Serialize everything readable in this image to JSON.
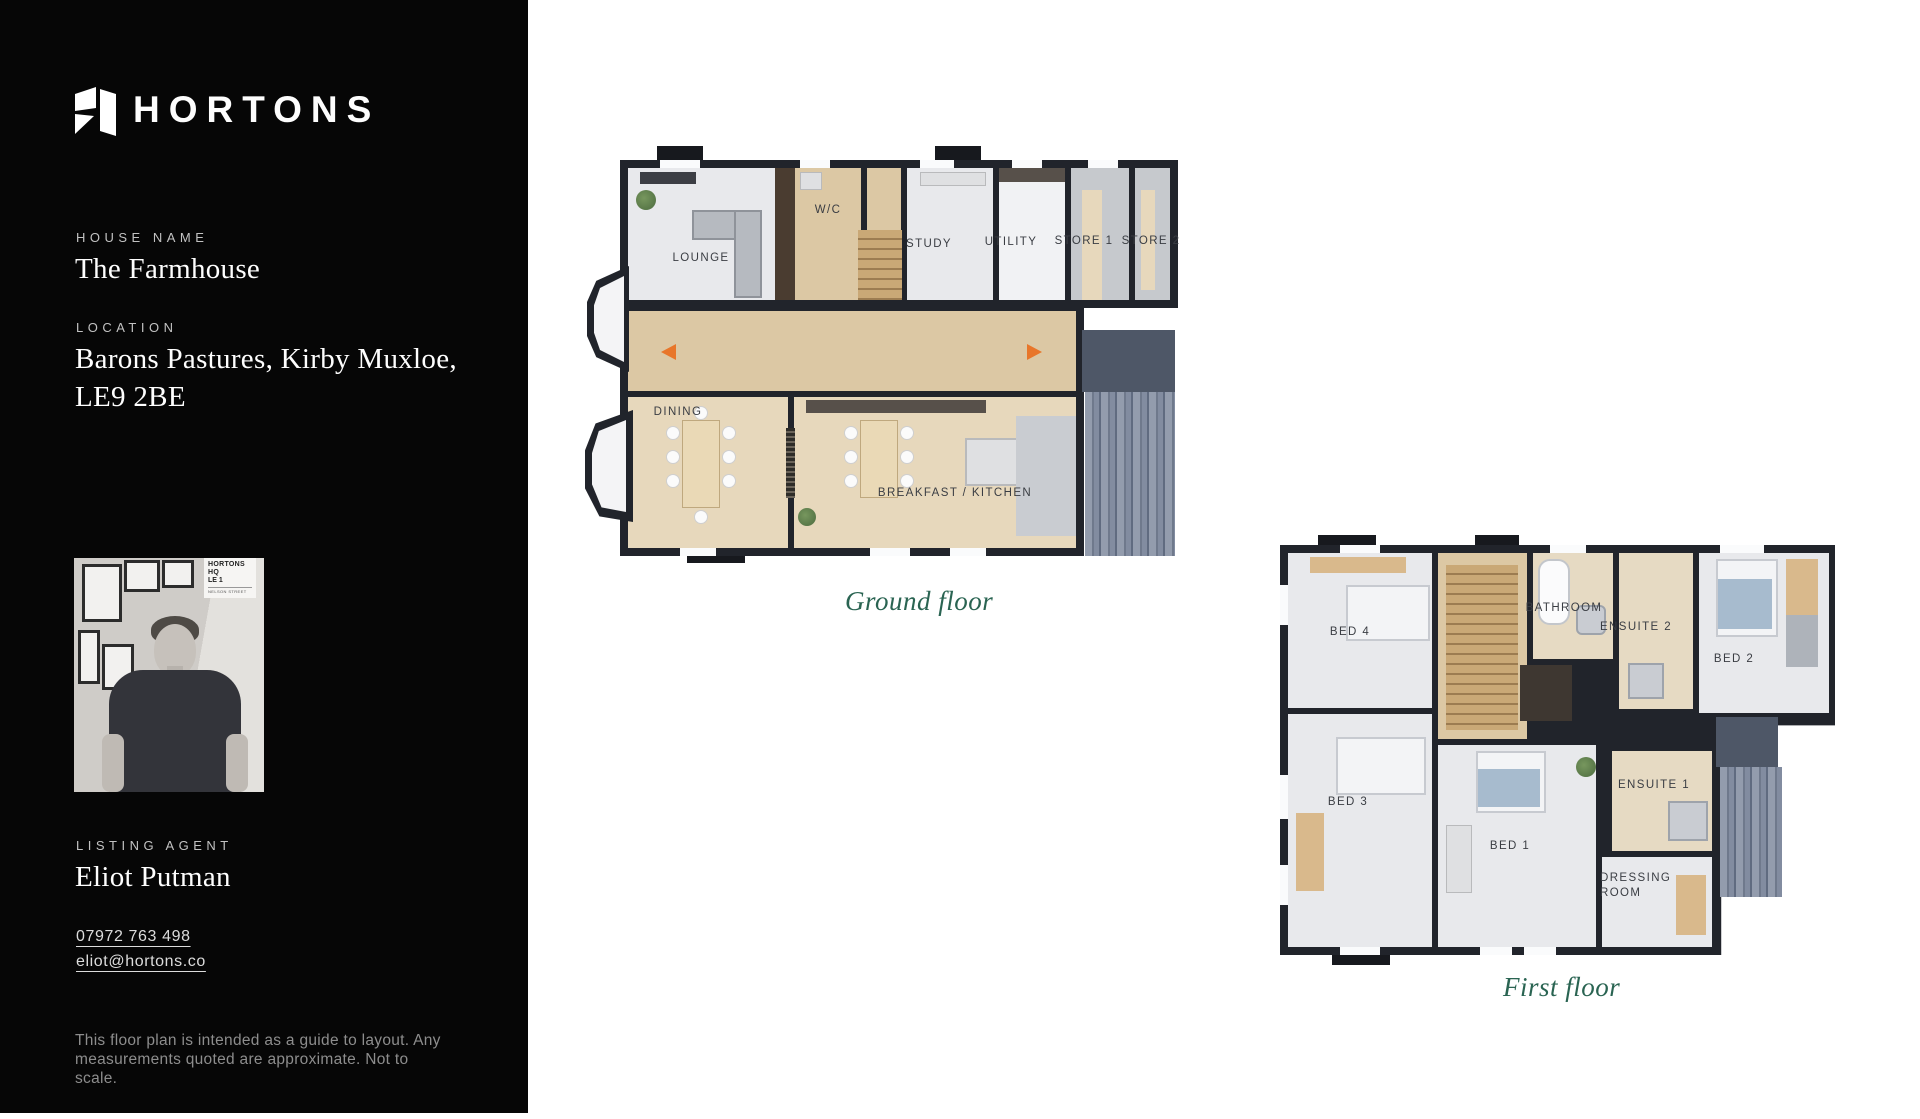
{
  "sidebar": {
    "brand": "HORTONS",
    "house_name_label": "HOUSE NAME",
    "house_name": "The Farmhouse",
    "location_label": "LOCATION",
    "location_line1": "Barons Pastures, Kirby Muxloe,",
    "location_line2": "LE9 2BE",
    "agent_label": "LISTING AGENT",
    "agent_name": "Eliot Putman",
    "agent_phone": "07972 763 498",
    "agent_email": "eliot@hortons.co",
    "disclaimer_line1": "This floor plan is intended  as a guide to layout. Any",
    "disclaimer_line2": "measurements quoted are approximate. Not to scale.",
    "photo_sign": {
      "line1": "HORTONS HQ",
      "line2": "LE 1",
      "line3": "NELSON STREET"
    }
  },
  "ground_floor": {
    "caption": "Ground floor",
    "rooms": [
      {
        "label": "LOUNGE"
      },
      {
        "label": "W/C"
      },
      {
        "label": "STUDY"
      },
      {
        "label": "UTILITY"
      },
      {
        "label": "STORE 1"
      },
      {
        "label": "STORE 2"
      },
      {
        "label": "DINING"
      },
      {
        "label": "BREAKFAST / KITCHEN"
      }
    ]
  },
  "first_floor": {
    "caption": "First floor",
    "rooms": [
      {
        "label": "BED 4"
      },
      {
        "label": "BATHROOM"
      },
      {
        "label": "ENSUITE 2"
      },
      {
        "label": "BED 2"
      },
      {
        "label": "BED 3"
      },
      {
        "label": "BED 1"
      },
      {
        "label": "ENSUITE 1"
      },
      {
        "label": "DRESSING ROOM"
      }
    ]
  },
  "colors": {
    "sidebar_bg": "#060606",
    "caption_green": "#2a6452",
    "wall": "#21242b",
    "entrance_arrow_orange": "#e8762a",
    "terrace_slate": "#4e5767"
  }
}
